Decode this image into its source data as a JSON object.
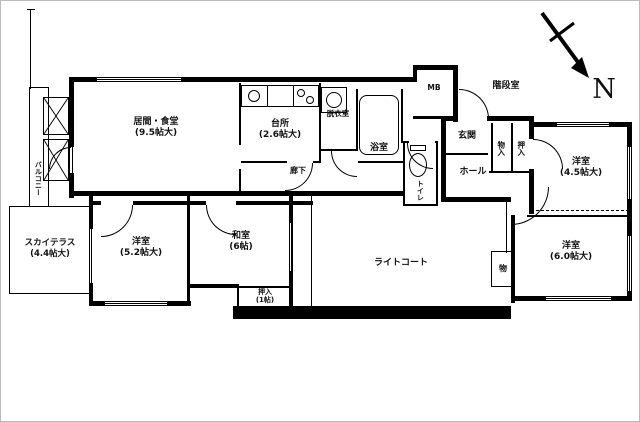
{
  "compass": {
    "label": "N"
  },
  "rooms": {
    "living": {
      "name": "居間・食堂",
      "size": "(9.5帖大)"
    },
    "kitchen": {
      "name": "台所",
      "size": "(2.6帖大)"
    },
    "dressing": {
      "name": "脱衣室"
    },
    "bath": {
      "name": "浴室"
    },
    "toilet": {
      "name": "トイレ"
    },
    "mb": {
      "name": "MB"
    },
    "stairwell": {
      "name": "階段室"
    },
    "entrance": {
      "name": "玄関"
    },
    "hall": {
      "name": "ホール"
    },
    "corridor": {
      "name": "廊下"
    },
    "closet_left": {
      "name": "物入"
    },
    "closet_right": {
      "name": "押入"
    },
    "western_ne": {
      "name": "洋室",
      "size": "(4.5帖大)"
    },
    "western_se": {
      "name": "洋室",
      "size": "(6.0帖大)"
    },
    "western_sw": {
      "name": "洋室",
      "size": "(5.2帖大)"
    },
    "washitsu": {
      "name": "和室",
      "size": "(6帖)"
    },
    "oshiire": {
      "name": "押入",
      "size": "(1帖)"
    },
    "sky_terrace": {
      "name": "スカイテラス",
      "size": "(4.4帖大)"
    },
    "light_court": {
      "name": "ライトコート"
    },
    "balcony": {
      "name": "バルコニー"
    },
    "storage": {
      "name": "物"
    }
  }
}
